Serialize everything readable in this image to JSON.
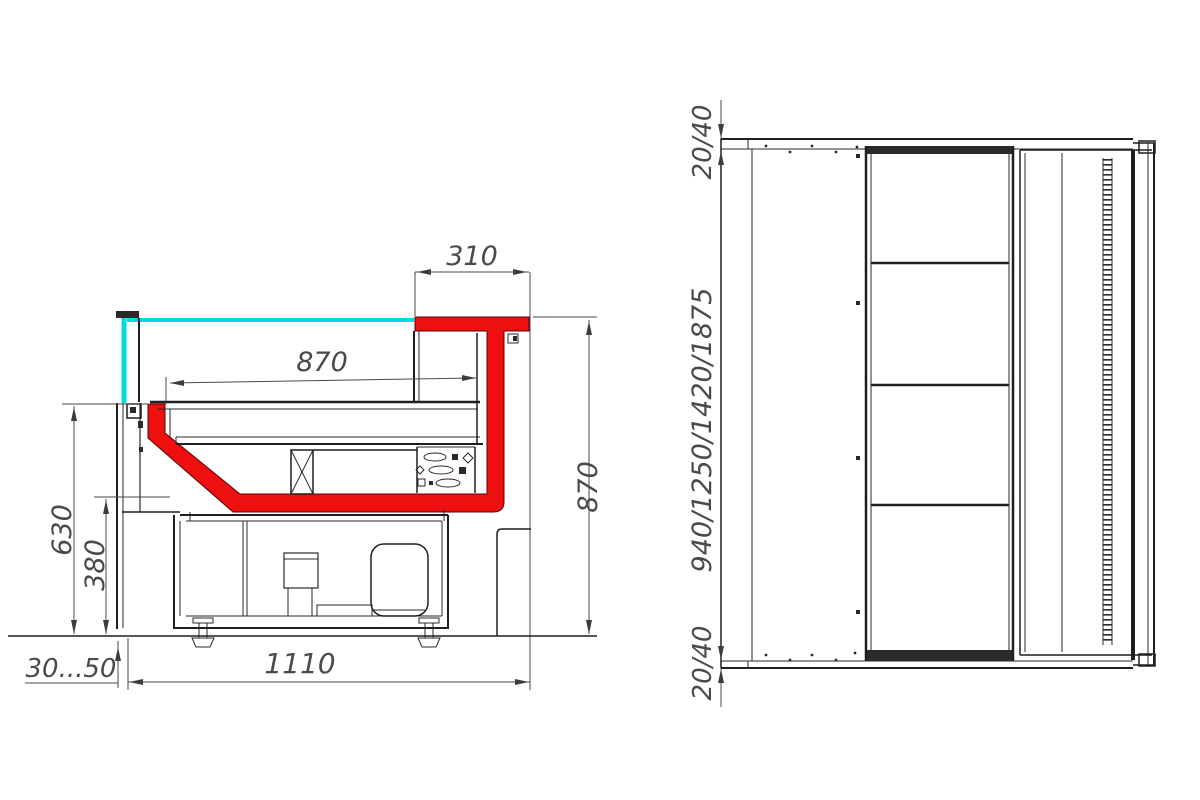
{
  "colors": {
    "background": "#ffffff",
    "line_dark": "#1f1f1f",
    "dim_gray": "#4a4a4a",
    "profile_red": "#ee0f0f",
    "glass_cyan": "#00dcdc"
  },
  "side_view": {
    "dims": {
      "top_overhang": "310",
      "deck_length": "870",
      "overall_height": "870",
      "back_panel_height": "630",
      "well_bottom_height": "380",
      "foot_adjust_range": "30...50",
      "overall_depth": "1110"
    }
  },
  "plan_view": {
    "dims": {
      "end_overhang_top": "20/40",
      "length_options": "940/1250/1420/1875",
      "end_overhang_bottom": "20/40"
    }
  }
}
